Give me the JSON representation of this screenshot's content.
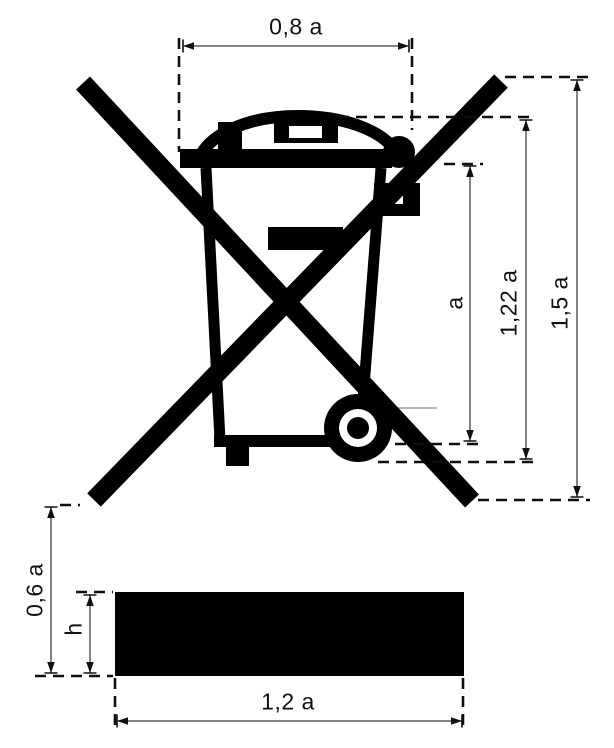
{
  "diagram": {
    "name": "crossed-out wheeled bin symbol with proportional dimensions",
    "labels": {
      "top_width": "0,8 a",
      "container_height": "a",
      "lid_height": "1,22 a",
      "overall_height": "1,5 a",
      "bar_gap": "0,6 a",
      "bar_thickness": "h",
      "bar_width": "1,2 a"
    },
    "colors": {
      "ink": "#000000",
      "dimension_line": "#5a5a5a",
      "background": "#ffffff"
    }
  }
}
